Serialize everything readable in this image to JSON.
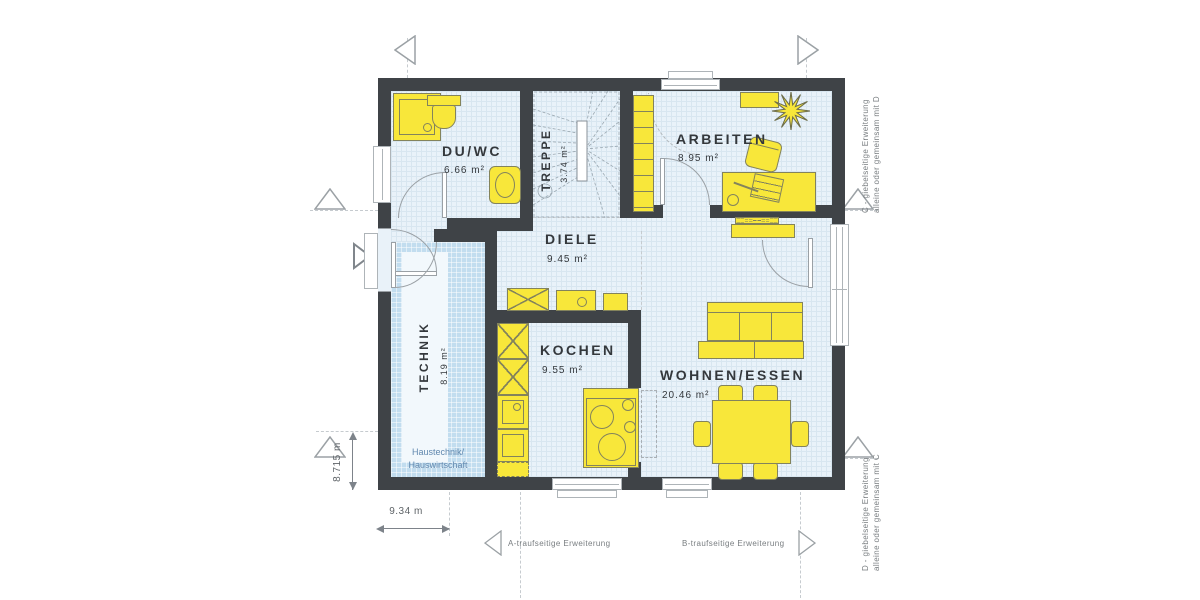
{
  "rooms": {
    "duwc": {
      "name": "DU/WC",
      "area": "6.66 m²"
    },
    "treppe": {
      "name": "TREPPE",
      "area": "3.74 m²"
    },
    "arbeiten": {
      "name": "ARBEITEN",
      "area": "8.95 m²"
    },
    "diele": {
      "name": "DIELE",
      "area": "9.45 m²"
    },
    "technik": {
      "name": "TECHNIK",
      "area": "8.19 m²",
      "note_line1": "Haustechnik/",
      "note_line2": "Hauswirtschaft"
    },
    "kochen": {
      "name": "KOCHEN",
      "area": "9.55 m²"
    },
    "wohnen": {
      "name": "WOHNEN/ESSEN",
      "area": "20.46 m²"
    }
  },
  "dimensions": {
    "width_label": "9.34 m",
    "depth_label": "8.715 m"
  },
  "extensions": {
    "a": "A-traufseitige Erweiterung",
    "b": "B-traufseitige Erweiterung",
    "c_line1": "C - giebelseitige Erweiterung",
    "c_line2": "alleine oder gemeinsam mit D",
    "d_line1": "D - giebelseitige Erweiterung",
    "d_line2": "alleine oder gemeinsam mit C"
  },
  "icons": {
    "extension_marker": "open-triangle",
    "entrance_marker": "entrance-arrow-triangle",
    "plant": "starburst-plant"
  },
  "colors": {
    "wall": "#3f4347",
    "room_fill": "#e9f2f9",
    "grid_line": "#d8e6f0",
    "technik_fill": "#c2ddef",
    "furniture_yellow": "#f8e73a",
    "note_text": "#6188ae",
    "label_text": "#34383c",
    "annotation_text": "#787d80"
  }
}
